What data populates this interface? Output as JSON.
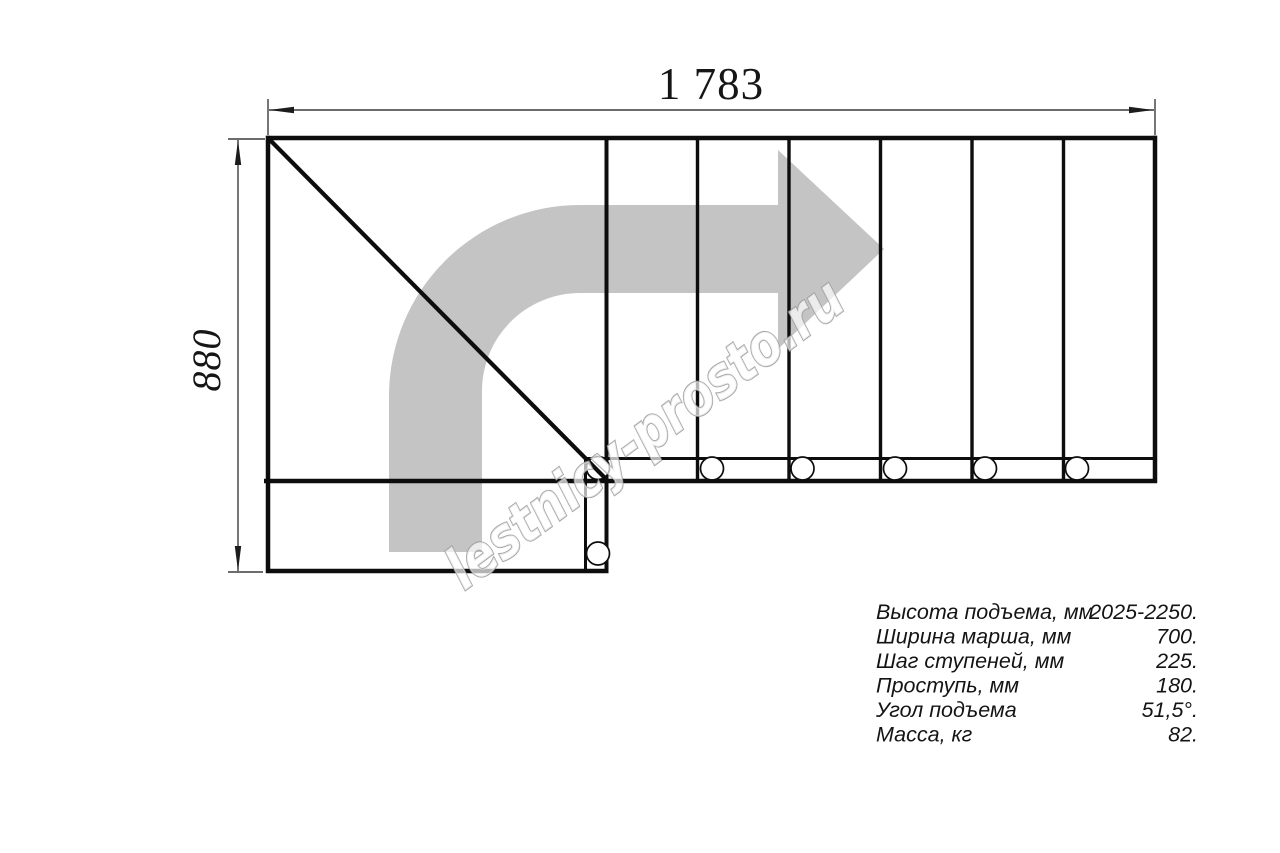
{
  "drawing": {
    "title": "staircase-top-view-plan",
    "dimensions": {
      "width_label": "1 783",
      "depth_label": "880"
    },
    "watermark": {
      "text": "lestnicy-prosto.ru"
    },
    "specs": {
      "rows": [
        {
          "label": "Высота подъема, мм",
          "value": "2025-2250."
        },
        {
          "label": "Ширина марша, мм",
          "value": "700."
        },
        {
          "label": "Шаг ступеней, мм",
          "value": "225."
        },
        {
          "label": "Проступь, мм",
          "value": "180."
        },
        {
          "label": "Угол подъема",
          "value": "51,5°."
        },
        {
          "label": "Масса, кг",
          "value": "82."
        }
      ]
    },
    "colors": {
      "line_black": "#0d0d0d",
      "dimension_gray": "#3c3c3c",
      "arrow_gray": "#c4c4c4",
      "watermark_stroke": "#9b9b9b",
      "background": "#ffffff"
    }
  }
}
